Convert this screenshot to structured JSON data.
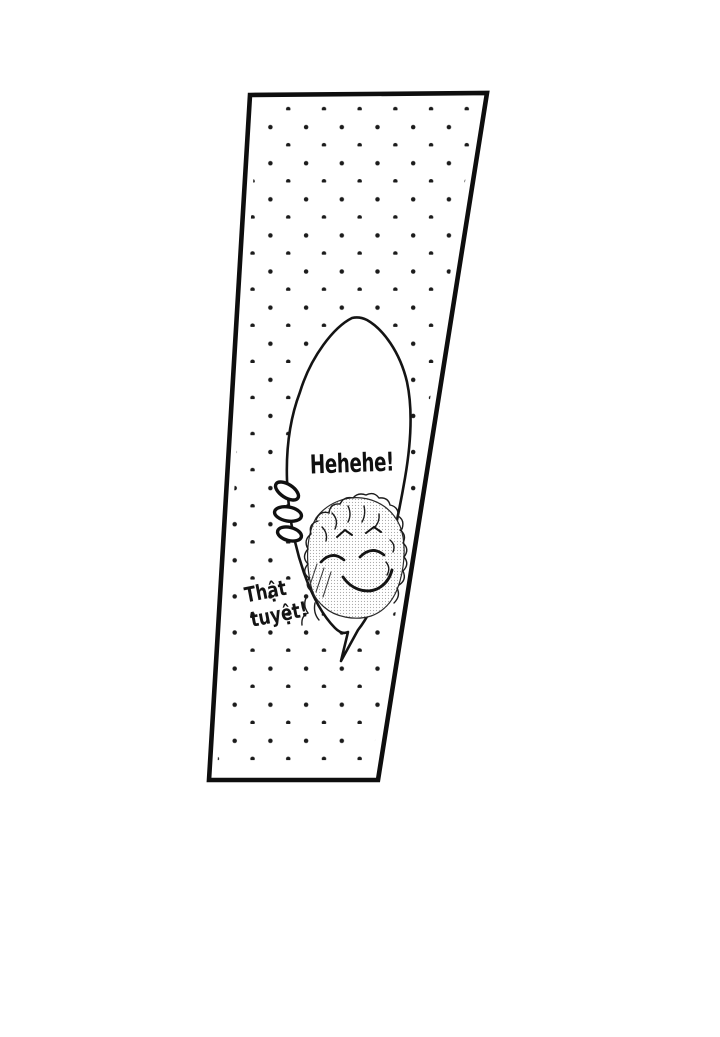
{
  "page": {
    "background_color": "#ffffff",
    "ink_color": "#141414"
  },
  "panel": {
    "border_color": "#0e0e0e",
    "screentone_dot_color": "#1b1b1b"
  },
  "speech_bubble": {
    "text": "Hehehe!",
    "fill_color": "#ffffff"
  },
  "caption": {
    "line1": "Thật",
    "line2": "tuyệt!"
  }
}
